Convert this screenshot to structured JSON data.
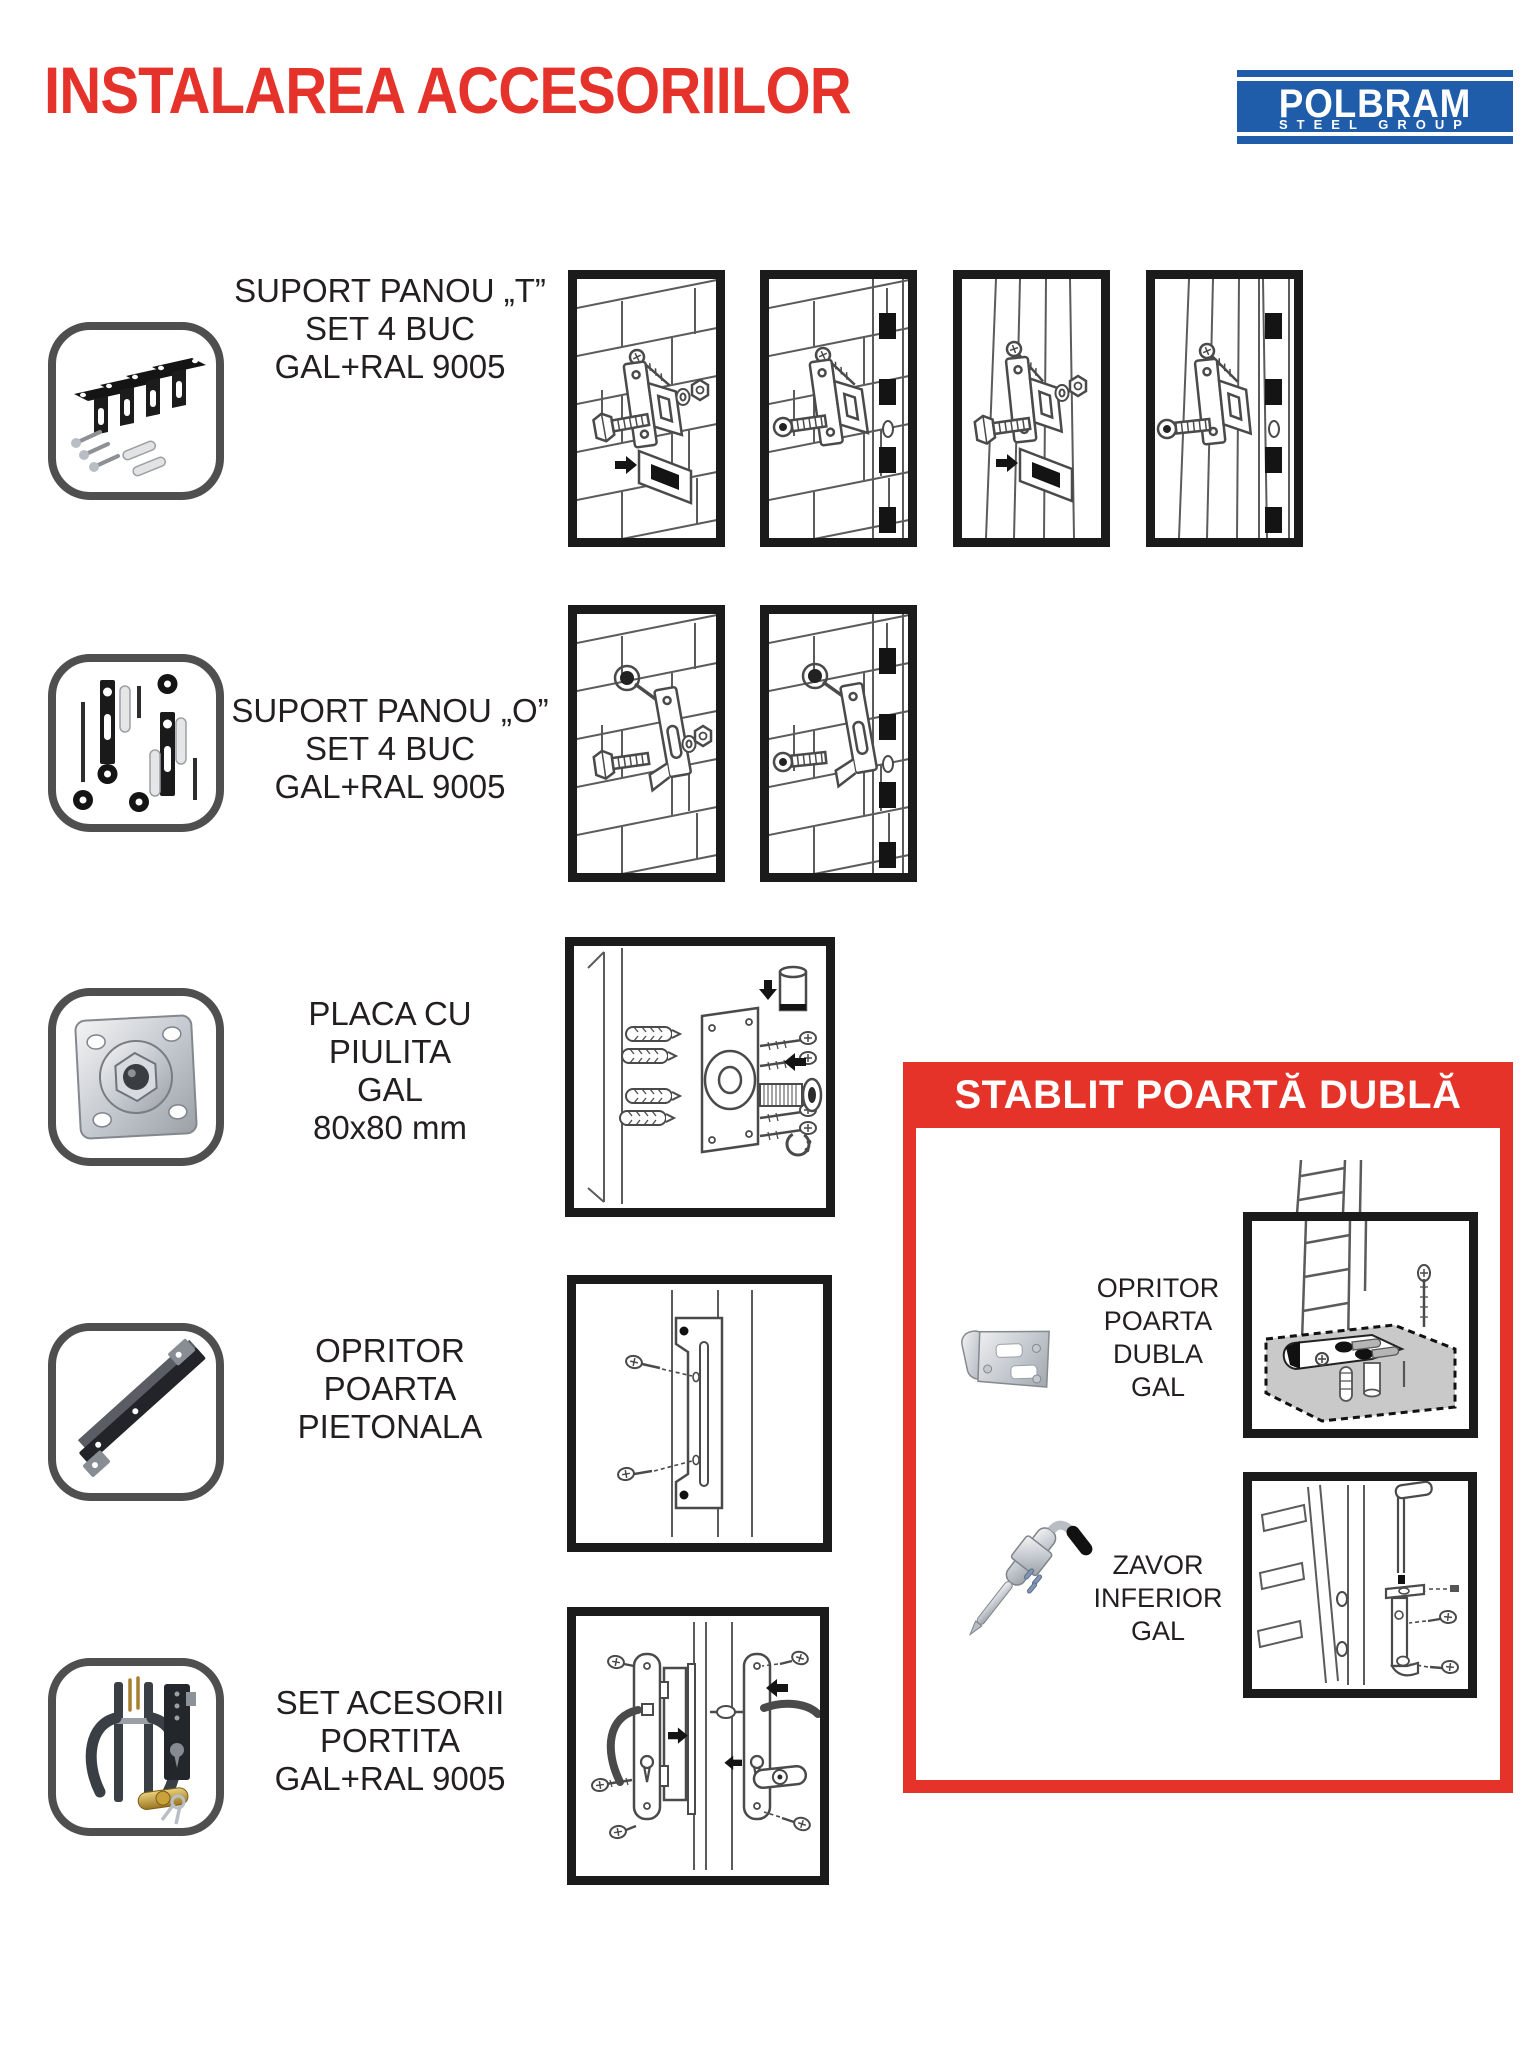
{
  "page": {
    "title": "INSTALAREA ACCESORIILOR"
  },
  "logo": {
    "name": "POLBRAM",
    "subtitle": "STEEL GROUP"
  },
  "colors": {
    "accent_red": "#e63329",
    "logo_blue": "#1f5ca9",
    "icon_border_gray": "#4f4f4f",
    "frame_black": "#1b1b1b",
    "text_dark": "#231f20"
  },
  "products": [
    {
      "icon": "t-bracket-set-photo",
      "steps": 4,
      "label_lines": [
        "SUPORT PANOU „T”",
        "SET 4 BUC",
        "GAL+RAL 9005"
      ]
    },
    {
      "icon": "o-bracket-set-photo",
      "steps": 2,
      "label_lines": [
        "SUPORT PANOU „O”",
        "SET 4 BUC",
        "GAL+RAL 9005"
      ]
    },
    {
      "icon": "nut-plate-photo",
      "steps": 1,
      "label_lines": [
        "PLACA CU",
        "PIULITA",
        "GAL",
        "80x80 mm"
      ]
    },
    {
      "icon": "gate-stop-bar-photo",
      "steps": 1,
      "label_lines": [
        "OPRITOR",
        "POARTA",
        "PIETONALA"
      ]
    },
    {
      "icon": "gate-lock-set-photo",
      "steps": 1,
      "label_lines": [
        "SET ACESORII",
        "PORTITA",
        "GAL+RAL 9005"
      ]
    }
  ],
  "double_gate_panel": {
    "title": "STABLIT POARTĂ DUBLĂ",
    "items": [
      {
        "icon": "double-gate-stop-photo",
        "label_lines": [
          "OPRITOR",
          "POARTA",
          "DUBLA",
          "GAL"
        ]
      },
      {
        "icon": "drop-bolt-photo",
        "label_lines": [
          "ZAVOR",
          "INFERIOR",
          "GAL"
        ]
      }
    ]
  }
}
